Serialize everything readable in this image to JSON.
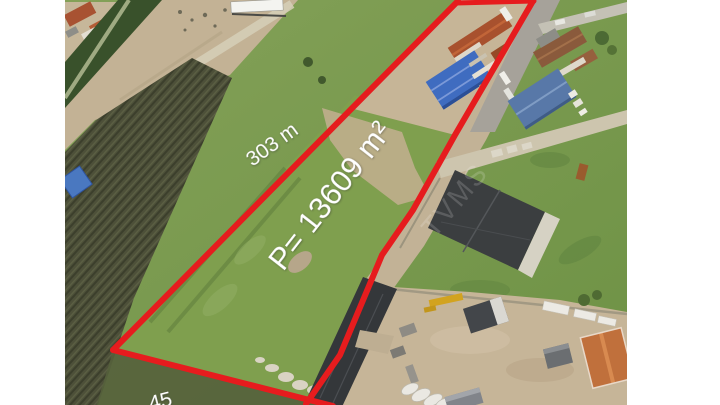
{
  "photo": {
    "description": "Oblique aerial photograph of a long narrow land plot outlined in red, surrounded by fields, dirt roads, warehouses and houses",
    "margins_color": "#ffffff"
  },
  "labels": {
    "area": "P= 13609 m²",
    "side_length": "303 m",
    "bottom_width": "45",
    "roof_watermark": "TVMS"
  },
  "measurements": {
    "area_m2": 13609,
    "length_m": 303
  },
  "colors": {
    "boundary_red": "#e61c1e",
    "label_text": "#ffffff",
    "grass": "#7a9650",
    "plot_grass": "#7f9f4e",
    "dirt_field": "#c3b295",
    "plowed_field": "#4b4f3a",
    "dirt_road": "#c2b296",
    "asphalt_road": "#a6a29a",
    "warehouse_blue": "#3f6cc0",
    "warehouse_steel_blue": "#5878a8",
    "roof_red": "#a8512e",
    "roof_orange": "#c0703c",
    "dark_building": "#3a3d3f"
  }
}
